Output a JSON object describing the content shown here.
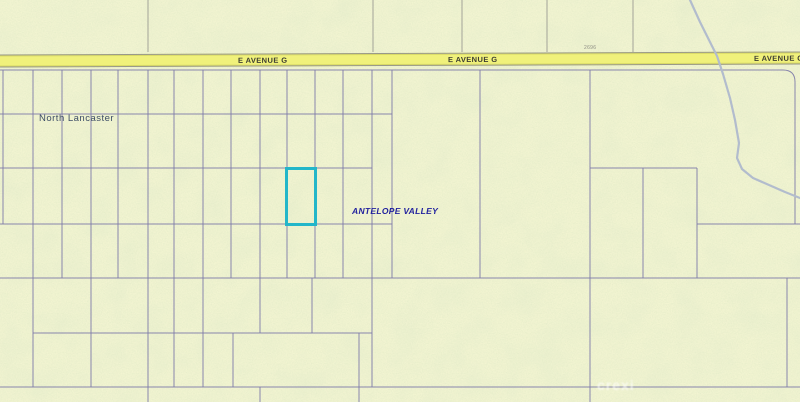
{
  "map": {
    "region_labels": {
      "north_lancaster": "North Lancaster",
      "antelope_valley": "ANTELOPE VALLEY"
    },
    "road": {
      "name": "E AVENUE G",
      "label_repeats": 3,
      "elevation_marker": "2696"
    },
    "watermark": "crexi",
    "colors": {
      "background": "#f2f4d1",
      "speckle_green": "#c9d8a2",
      "road_fill": "#f0f17b",
      "road_edge": "#98988a",
      "road_text": "#3c3c32",
      "parcel_line": "#7d7aa8",
      "boundary_gray": "#9a9a92",
      "stream": "#b2bccd",
      "highlight": "#23b6c9",
      "label_slate": "#3d4d66",
      "label_blue": "#22229e",
      "marker_gray": "#8f8f85"
    },
    "highlight_parcel": {
      "x": 285,
      "y": 167,
      "width": 32,
      "height": 59
    },
    "geometry": {
      "parcel_v": [
        [
          3,
          70,
          224
        ],
        [
          33,
          70,
          387
        ],
        [
          62,
          70,
          278
        ],
        [
          91,
          70,
          387
        ],
        [
          118,
          70,
          278
        ],
        [
          148,
          70,
          402
        ],
        [
          174,
          70,
          387
        ],
        [
          203,
          70,
          387
        ],
        [
          231,
          70,
          278
        ],
        [
          233,
          333,
          387
        ],
        [
          260,
          70,
          333
        ],
        [
          260,
          387,
          402
        ],
        [
          287,
          70,
          278
        ],
        [
          315,
          70,
          278
        ],
        [
          312,
          278,
          333
        ],
        [
          343,
          70,
          278
        ],
        [
          359,
          333,
          402
        ],
        [
          372,
          70,
          387
        ],
        [
          392,
          70,
          278
        ],
        [
          480,
          70,
          278
        ],
        [
          590,
          70,
          402
        ],
        [
          643,
          168,
          278
        ],
        [
          697,
          168,
          278
        ],
        [
          787,
          278,
          387
        ]
      ],
      "parcel_h": [
        [
          70,
          0,
          783
        ],
        [
          114,
          0,
          392
        ],
        [
          168,
          0,
          372
        ],
        [
          168,
          590,
          697
        ],
        [
          224,
          0,
          392
        ],
        [
          224,
          697,
          800
        ],
        [
          278,
          0,
          800
        ],
        [
          333,
          33,
          372
        ],
        [
          387,
          0,
          800
        ]
      ],
      "boundary_v": [
        [
          148,
          0,
          52
        ],
        [
          373,
          0,
          52
        ],
        [
          462,
          0,
          52
        ],
        [
          547,
          0,
          52
        ],
        [
          633,
          0,
          52
        ]
      ],
      "corner_path": "M783,70 Q795,70 795,82 L795,224",
      "stream_points": "690,0 700,22 711,44 717,56 723,74 730,98 735,120 739,143 737,158 742,169 753,178 769,185 785,192 800,198"
    }
  }
}
